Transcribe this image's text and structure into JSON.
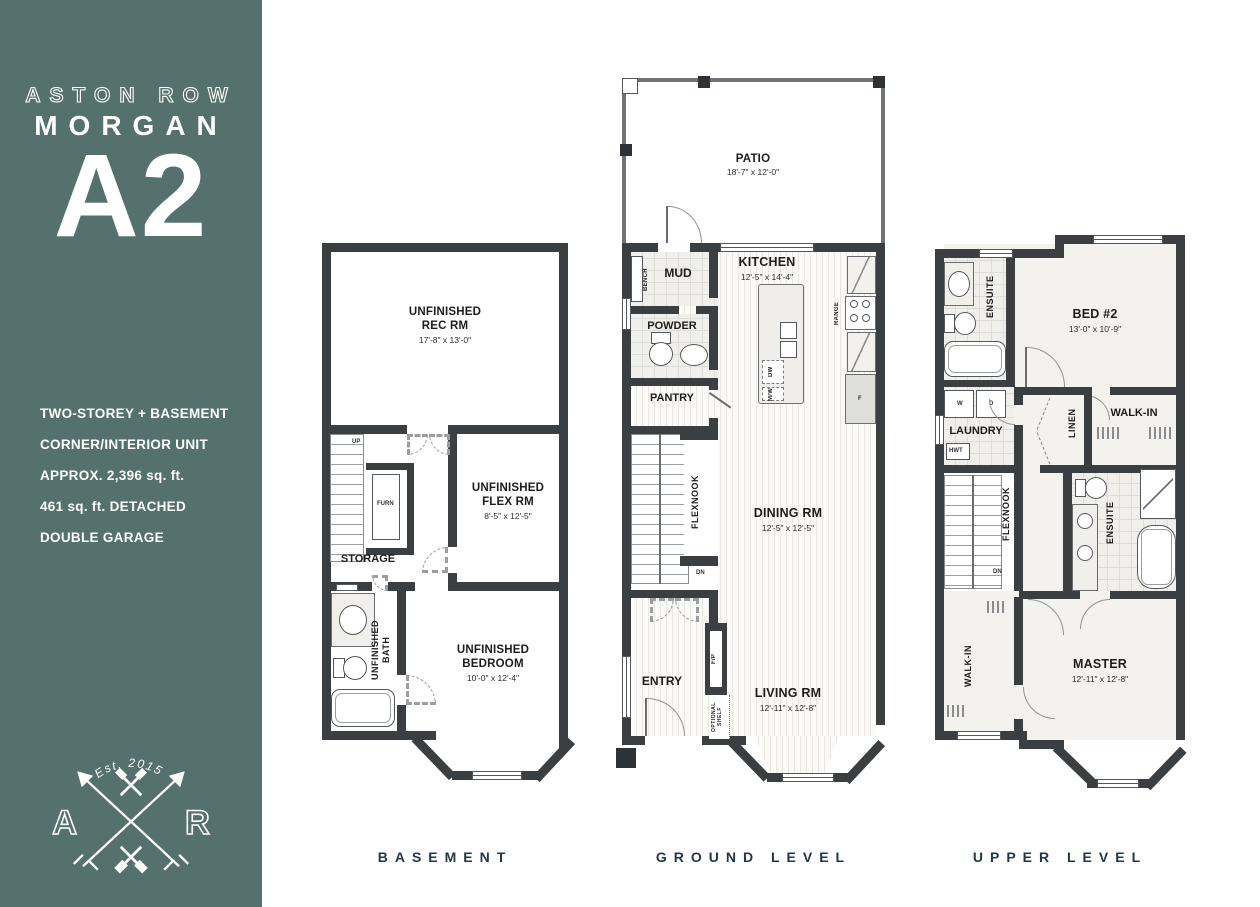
{
  "sidebar": {
    "background_color": "#55716E",
    "brand_top": "ASTON ROW",
    "brand_name": "MORGAN",
    "plan_code": "A2",
    "details": [
      "TWO-STOREY + BASEMENT",
      "CORNER/INTERIOR UNIT",
      "APPROX. 2,396 sq. ft.",
      "461 sq. ft. DETACHED",
      "DOUBLE GARAGE"
    ],
    "logo": {
      "established": "Est. 2015",
      "monogram_left": "A",
      "monogram_right": "R"
    }
  },
  "floors": {
    "basement": {
      "label": "BASEMENT",
      "rec_room": {
        "name": "UNFINISHED\nREC RM",
        "dims": "17'-8\" x 13'-0\""
      },
      "flex_room": {
        "name": "UNFINISHED\nFLEX RM",
        "dims": "8'-5\" x 12'-5\""
      },
      "storage": "STORAGE",
      "furnace": "FURN",
      "bath": "UNFINISHED\nBATH",
      "bedroom": {
        "name": "UNFINISHED\nBEDROOM",
        "dims": "10'-0\" x 12'-4\""
      },
      "stair_up": "UP"
    },
    "ground": {
      "label": "GROUND LEVEL",
      "patio": {
        "name": "PATIO",
        "dims": "18'-7\" x 12'-0\""
      },
      "mud": "MUD",
      "bench": "BENCH",
      "kitchen": {
        "name": "KITCHEN",
        "dims": "12'-5\" x 14'-4\""
      },
      "range": "RANGE",
      "dishwasher": "DW",
      "microwave": "M/W",
      "fridge": "F",
      "powder": "POWDER",
      "pantry": "PANTRY",
      "flexnook": "FLEXNOOK",
      "dining": {
        "name": "DINING RM",
        "dims": "12'-5\" x 12'-5\""
      },
      "entry": "ENTRY",
      "fireplace": "F/P",
      "optional_shelf": "OPTIONAL SHELF",
      "living": {
        "name": "LIVING RM",
        "dims": "12'-11\" x 12'-8\""
      },
      "stair_up": "UP",
      "stair_dn": "DN"
    },
    "upper": {
      "label": "UPPER LEVEL",
      "ensuite2": "ENSUITE",
      "bed2": {
        "name": "BED #2",
        "dims": "13'-0\" x 10'-9\""
      },
      "washer": "W",
      "dryer": "D",
      "laundry": "LAUNDRY",
      "hot_water_tank": "HWT",
      "linen": "LINEN",
      "walkin_bed2": "WALK-IN",
      "flexnook": "FLEXNOOK",
      "master_ensuite": "ENSUITE",
      "walkin_master": "WALK-IN",
      "master": {
        "name": "MASTER",
        "dims": "12'-11\" x 12'-8\""
      },
      "stair_dn": "DN"
    }
  }
}
